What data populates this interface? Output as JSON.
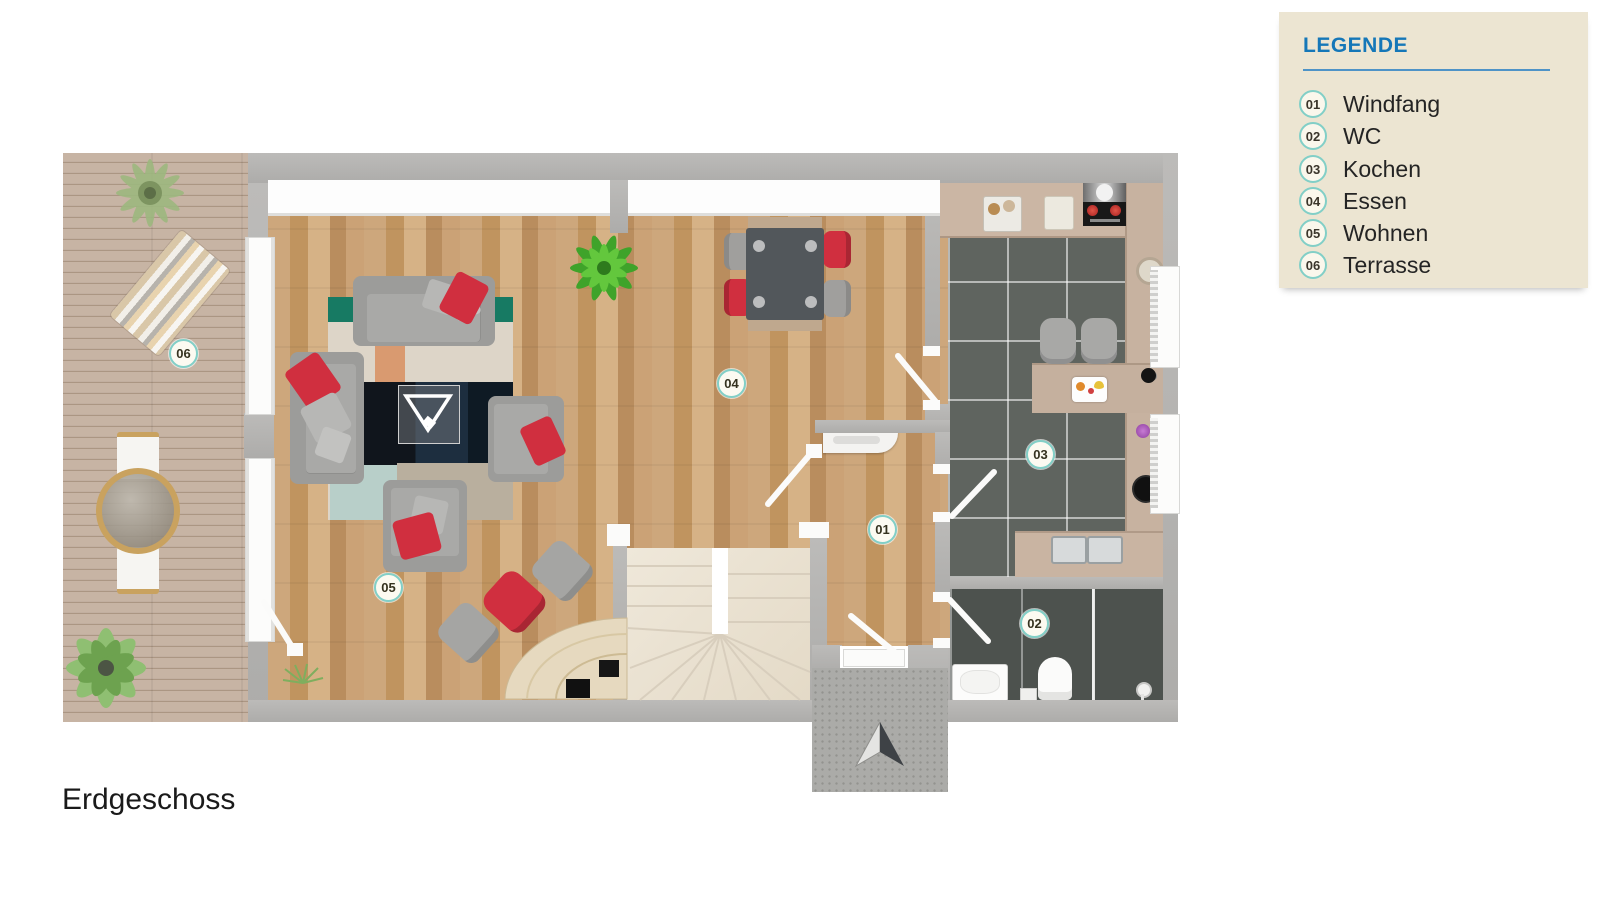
{
  "title": "Erdgeschoss",
  "legend": {
    "title": "LEGENDE",
    "items": [
      {
        "num": "01",
        "label": "Windfang"
      },
      {
        "num": "02",
        "label": "WC"
      },
      {
        "num": "03",
        "label": "Kochen"
      },
      {
        "num": "04",
        "label": "Essen"
      },
      {
        "num": "05",
        "label": "Wohnen"
      },
      {
        "num": "06",
        "label": "Terrasse"
      }
    ]
  },
  "plan": {
    "badges": [
      {
        "num": "01",
        "room": "Windfang"
      },
      {
        "num": "02",
        "room": "WC"
      },
      {
        "num": "03",
        "room": "Kochen"
      },
      {
        "num": "04",
        "room": "Essen"
      },
      {
        "num": "05",
        "room": "Wohnen"
      },
      {
        "num": "06",
        "room": "Terrasse"
      }
    ]
  },
  "colors": {
    "accent_blue": "#1577b8",
    "legend_bg": "#ece5d2",
    "badge_ring": "#82cfc7",
    "wall_gray": "#b1b0ae",
    "accent_red": "#d02f3f",
    "wood_floor": "#c89e71",
    "terrace_deck": "#c3b0a0",
    "kitchen_tile": "#5f645f",
    "wc_tile": "#4d524e",
    "stair_cream": "#ebe3d4"
  }
}
